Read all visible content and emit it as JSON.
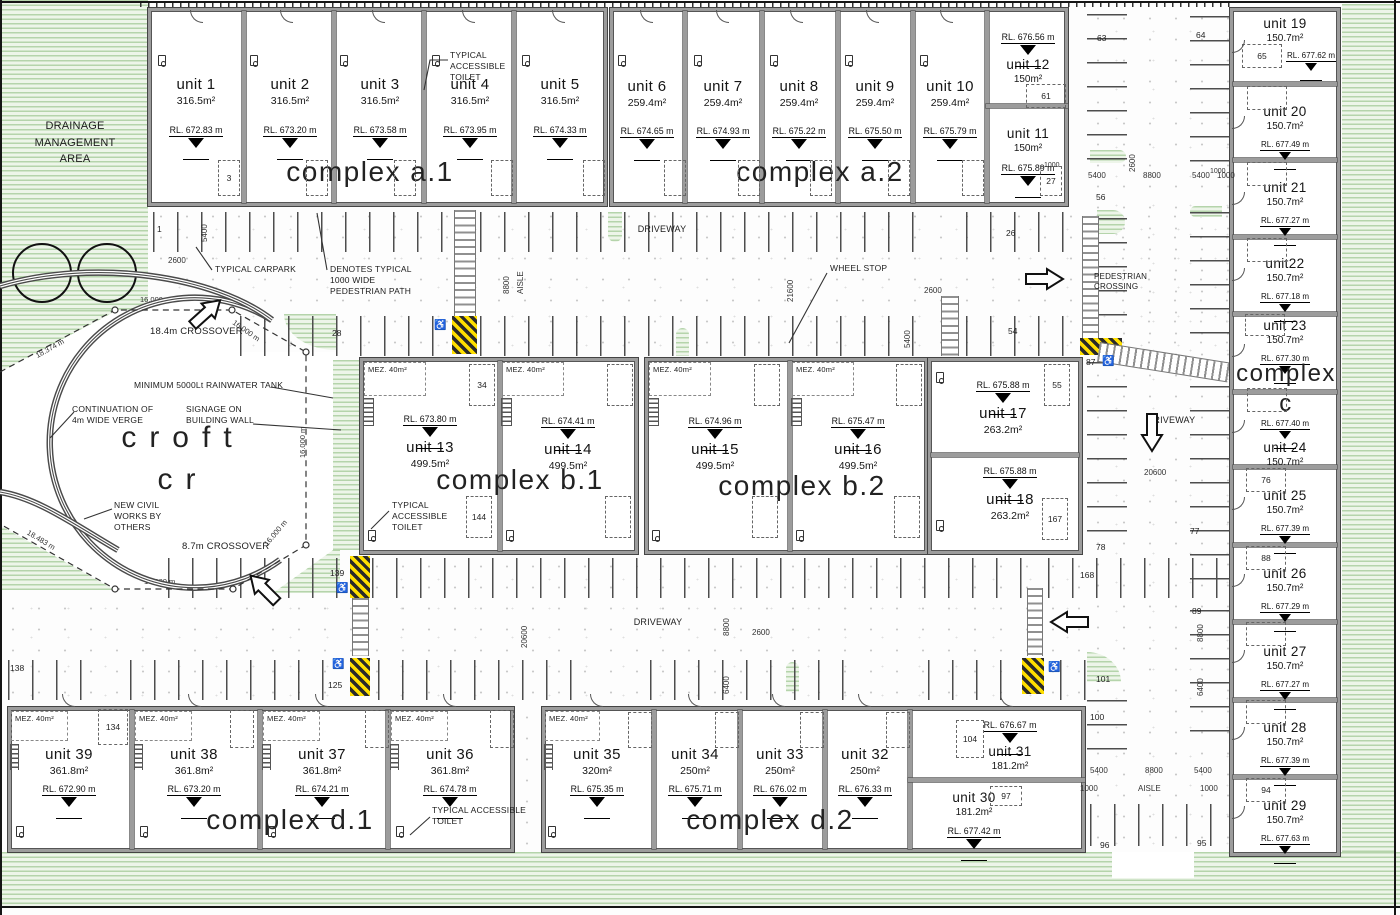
{
  "complexes": {
    "a1": "complex a.1",
    "a2": "complex a.2",
    "b1": "complex b.1",
    "b2": "complex b.2",
    "cw": "complex",
    "cl": "c",
    "d1": "complex d.1",
    "d2": "complex d.2"
  },
  "units": [
    {
      "id": 1,
      "name": "unit 1",
      "area": "316.5m²",
      "rl": "RL. 672.83 m"
    },
    {
      "id": 2,
      "name": "unit 2",
      "area": "316.5m²",
      "rl": "RL. 673.20 m"
    },
    {
      "id": 3,
      "name": "unit 3",
      "area": "316.5m²",
      "rl": "RL. 673.58 m"
    },
    {
      "id": 4,
      "name": "unit 4",
      "area": "316.5m²",
      "rl": "RL. 673.95 m"
    },
    {
      "id": 5,
      "name": "unit 5",
      "area": "316.5m²",
      "rl": "RL. 674.33 m"
    },
    {
      "id": 6,
      "name": "unit 6",
      "area": "259.4m²",
      "rl": "RL. 674.65 m"
    },
    {
      "id": 7,
      "name": "unit 7",
      "area": "259.4m²",
      "rl": "RL. 674.93 m"
    },
    {
      "id": 8,
      "name": "unit 8",
      "area": "259.4m²",
      "rl": "RL. 675.22 m"
    },
    {
      "id": 9,
      "name": "unit 9",
      "area": "259.4m²",
      "rl": "RL. 675.50 m"
    },
    {
      "id": 10,
      "name": "unit 10",
      "area": "259.4m²",
      "rl": "RL. 675.79 m"
    },
    {
      "id": 11,
      "name": "unit 11",
      "area": "150m²",
      "rl": "RL. 675.89 m"
    },
    {
      "id": 12,
      "name": "unit 12",
      "area": "150m²",
      "rl": "RL. 676.56 m"
    },
    {
      "id": 13,
      "name": "unit 13",
      "area": "499.5m²",
      "rl": "RL. 673.80 m"
    },
    {
      "id": 14,
      "name": "unit 14",
      "area": "499.5m²",
      "rl": "RL. 674.41 m"
    },
    {
      "id": 15,
      "name": "unit 15",
      "area": "499.5m²",
      "rl": "RL. 674.96 m"
    },
    {
      "id": 16,
      "name": "unit 16",
      "area": "499.5m²",
      "rl": "RL. 675.47 m"
    },
    {
      "id": 17,
      "name": "unit 17",
      "area": "263.2m²",
      "rl": "RL. 675.88 m"
    },
    {
      "id": 18,
      "name": "unit 18",
      "area": "263.2m²",
      "rl": "RL. 675.88 m"
    },
    {
      "id": 19,
      "name": "unit 19",
      "area": "150.7m²",
      "rl": "RL. 677.62 m"
    },
    {
      "id": 20,
      "name": "unit 20",
      "area": "150.7m²",
      "rl": "RL. 677.49 m"
    },
    {
      "id": 21,
      "name": "unit 21",
      "area": "150.7m²",
      "rl": "RL. 677.27 m"
    },
    {
      "id": 22,
      "name": "unit22",
      "area": "150.7m²",
      "rl": "RL. 677.18 m"
    },
    {
      "id": 23,
      "name": "unit 23",
      "area": "150.7m²",
      "rl": "RL. 677.30 m"
    },
    {
      "id": 24,
      "name": "unit 24",
      "area": "150.7m²",
      "rl": "RL. 677.40 m"
    },
    {
      "id": 25,
      "name": "unit 25",
      "area": "150.7m²",
      "rl": "RL. 677.39 m"
    },
    {
      "id": 26,
      "name": "unit 26",
      "area": "150.7m²",
      "rl": "RL. 677.29 m"
    },
    {
      "id": 27,
      "name": "unit 27",
      "area": "150.7m²",
      "rl": "RL. 677.27 m"
    },
    {
      "id": 28,
      "name": "unit 28",
      "area": "150.7m²",
      "rl": "RL. 677.39 m"
    },
    {
      "id": 29,
      "name": "unit 29",
      "area": "150.7m²",
      "rl": "RL. 677.63 m"
    },
    {
      "id": 30,
      "name": "unit 30",
      "area": "181.2m²",
      "rl": "RL. 677.42 m"
    },
    {
      "id": 31,
      "name": "unit 31",
      "area": "181.2m²",
      "rl": "RL. 676.67 m"
    },
    {
      "id": 32,
      "name": "unit 32",
      "area": "250m²",
      "rl": "RL. 676.33 m"
    },
    {
      "id": 33,
      "name": "unit 33",
      "area": "250m²",
      "rl": "RL. 676.02 m"
    },
    {
      "id": 34,
      "name": "unit 34",
      "area": "250m²",
      "rl": "RL. 675.71 m"
    },
    {
      "id": 35,
      "name": "unit 35",
      "area": "320m²",
      "rl": "RL. 675.35 m"
    },
    {
      "id": 36,
      "name": "unit 36",
      "area": "361.8m²",
      "rl": "RL. 674.78 m"
    },
    {
      "id": 37,
      "name": "unit 37",
      "area": "361.8m²",
      "rl": "RL. 674.21 m"
    },
    {
      "id": 38,
      "name": "unit 38",
      "area": "361.8m²",
      "rl": "RL. 673.20 m"
    },
    {
      "id": 39,
      "name": "unit 39",
      "area": "361.8m²",
      "rl": "RL. 672.90 m"
    }
  ],
  "labels": {
    "drainage": "DRAINAGE MANAGEMENT AREA",
    "toilet": "TYPICAL ACCESSIBLE TOILET",
    "carpark": "TYPICAL CARPARK",
    "path": "DENOTES TYPICAL 1000 WIDE PEDESTRIAN PATH",
    "crossover184": "18.4m CROSSOVER",
    "crossover87": "8.7m CROSSOVER",
    "rainwater": "MINIMUM 5000Lt RAINWATER TANK",
    "verge": "CONTINUATION OF 4m WIDE VERGE",
    "signage": "SIGNAGE ON BUILDING WALL",
    "civil": "NEW CIVIL WORKS BY OTHERS",
    "pedx": "PEDESTRIAN CROSSING",
    "driveway": "DRIVEWAY",
    "aisle": "AISLE",
    "wheelstop": "WHEEL STOP",
    "mez": "MEZ. 40m²",
    "road1": "croft",
    "road2": "cr"
  },
  "dims": {
    "d5400": "5400",
    "d2600": "2600",
    "d8800": "8800",
    "d1000": "1000",
    "d21600": "21600",
    "d20600": "20600",
    "d6400": "6400",
    "m16": "16.000 m",
    "m18374": "18.374 m",
    "m18483": "18.483 m"
  },
  "bays": {
    "n1": "1",
    "n3": "3",
    "n26": "26",
    "n27": "27",
    "n28": "28",
    "n34": "34",
    "n54": "54",
    "n55": "55",
    "n56": "56",
    "n61": "61",
    "n63": "63",
    "n64": "64",
    "n65": "65",
    "n76": "76",
    "n77": "77",
    "n78": "78",
    "n87": "87",
    "n88": "88",
    "n89": "89",
    "n94": "94",
    "n95": "95",
    "n96": "96",
    "n97": "97",
    "n100": "100",
    "n101": "101",
    "n104": "104",
    "n125": "125",
    "n134": "134",
    "n138": "138",
    "n139": "139",
    "n144": "144",
    "n167": "167",
    "n168": "168"
  },
  "colors": {
    "landscape_green": "#cfe3c8",
    "hazard_yellow": "#ffdf00",
    "wall_grey": "#9c9c9c"
  }
}
